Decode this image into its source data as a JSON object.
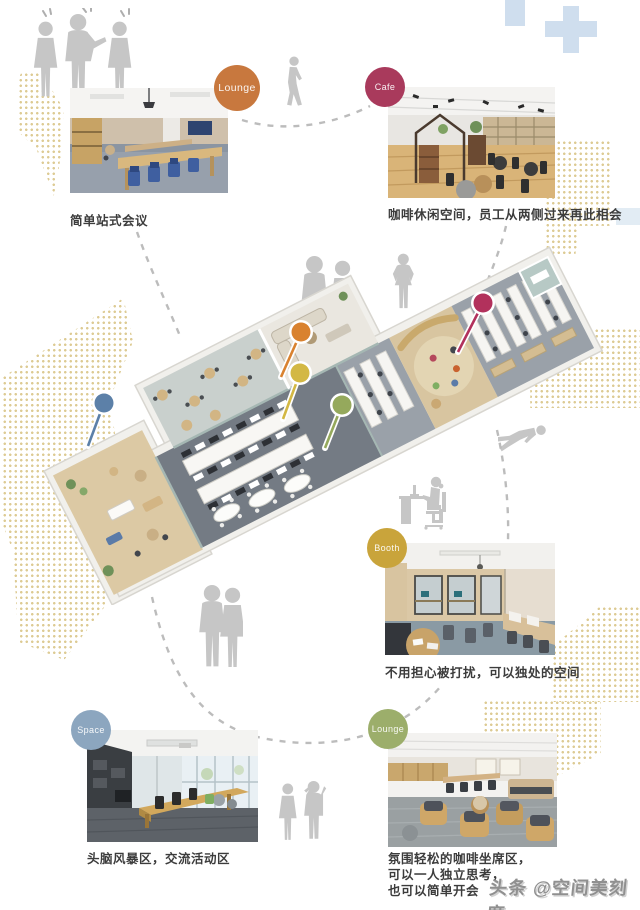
{
  "page_title": "办公空间布局信息图",
  "sections": {
    "lounge_top": {
      "badge_label": "Lounge",
      "color": "#c8783e",
      "caption": "简单站式会议"
    },
    "cafe": {
      "badge_label": "Cafe",
      "color": "#a93a5c",
      "caption": "咖啡休闲空间，员工从两侧过来再此相会"
    },
    "booth": {
      "badge_label": "Booth",
      "color": "#c9a43b",
      "caption": "不用担心被打扰，可以独处的空间"
    },
    "space": {
      "badge_label": "Space",
      "color": "#8ca6bf",
      "caption": "头脑风暴区，交流活动区"
    },
    "lounge_bottom": {
      "badge_label": "Lounge",
      "color": "#9cae6b",
      "caption": "氛围轻松的咖啡坐席区，\n可以一人独立思考，\n也可以简单开会"
    }
  },
  "pins": {
    "blue": {
      "color": "#5c80a8"
    },
    "orange": {
      "color": "#d9822f"
    },
    "yellow": {
      "color": "#d3b844"
    },
    "green": {
      "color": "#95a95c"
    },
    "red": {
      "color": "#b2315c"
    }
  },
  "decor": {
    "dot_color": "#d9c588",
    "dash_color": "#bcbcbc",
    "silhouette_color": "#c6c6c6",
    "plus_color": "#cfdeee"
  },
  "watermark": {
    "text": "头条 @空间美刻度"
  }
}
